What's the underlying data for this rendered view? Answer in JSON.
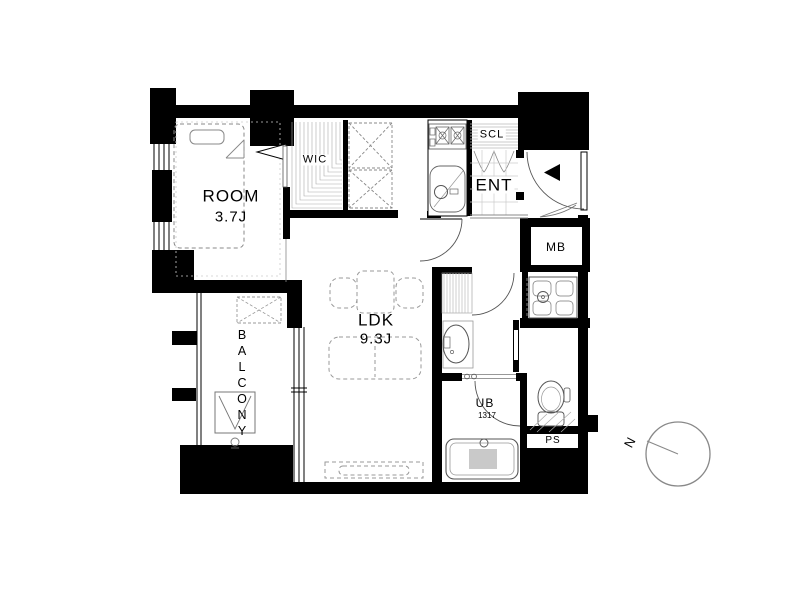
{
  "page": {
    "background": "#ffffff"
  },
  "plan": {
    "rooms": {
      "room": {
        "label": "ROOM",
        "size": "3.7J"
      },
      "wic": {
        "label": "WIC"
      },
      "scl": {
        "label": "SCL"
      },
      "ent": {
        "label": "ENT"
      },
      "mb": {
        "label": "MB"
      },
      "ldk": {
        "label": "LDK",
        "size": "9.3J"
      },
      "balcony": {
        "label": "BALCONY"
      },
      "ub": {
        "label": "UB",
        "size": "1317"
      },
      "ps": {
        "label": "PS"
      }
    },
    "compass": {
      "label": "N"
    },
    "colors": {
      "wall": "#000000",
      "background": "#ffffff",
      "fixture_line": "#666666",
      "furniture_line": "#999999",
      "hatch_line": "#bbbbbb",
      "compass_line": "#888888"
    }
  }
}
